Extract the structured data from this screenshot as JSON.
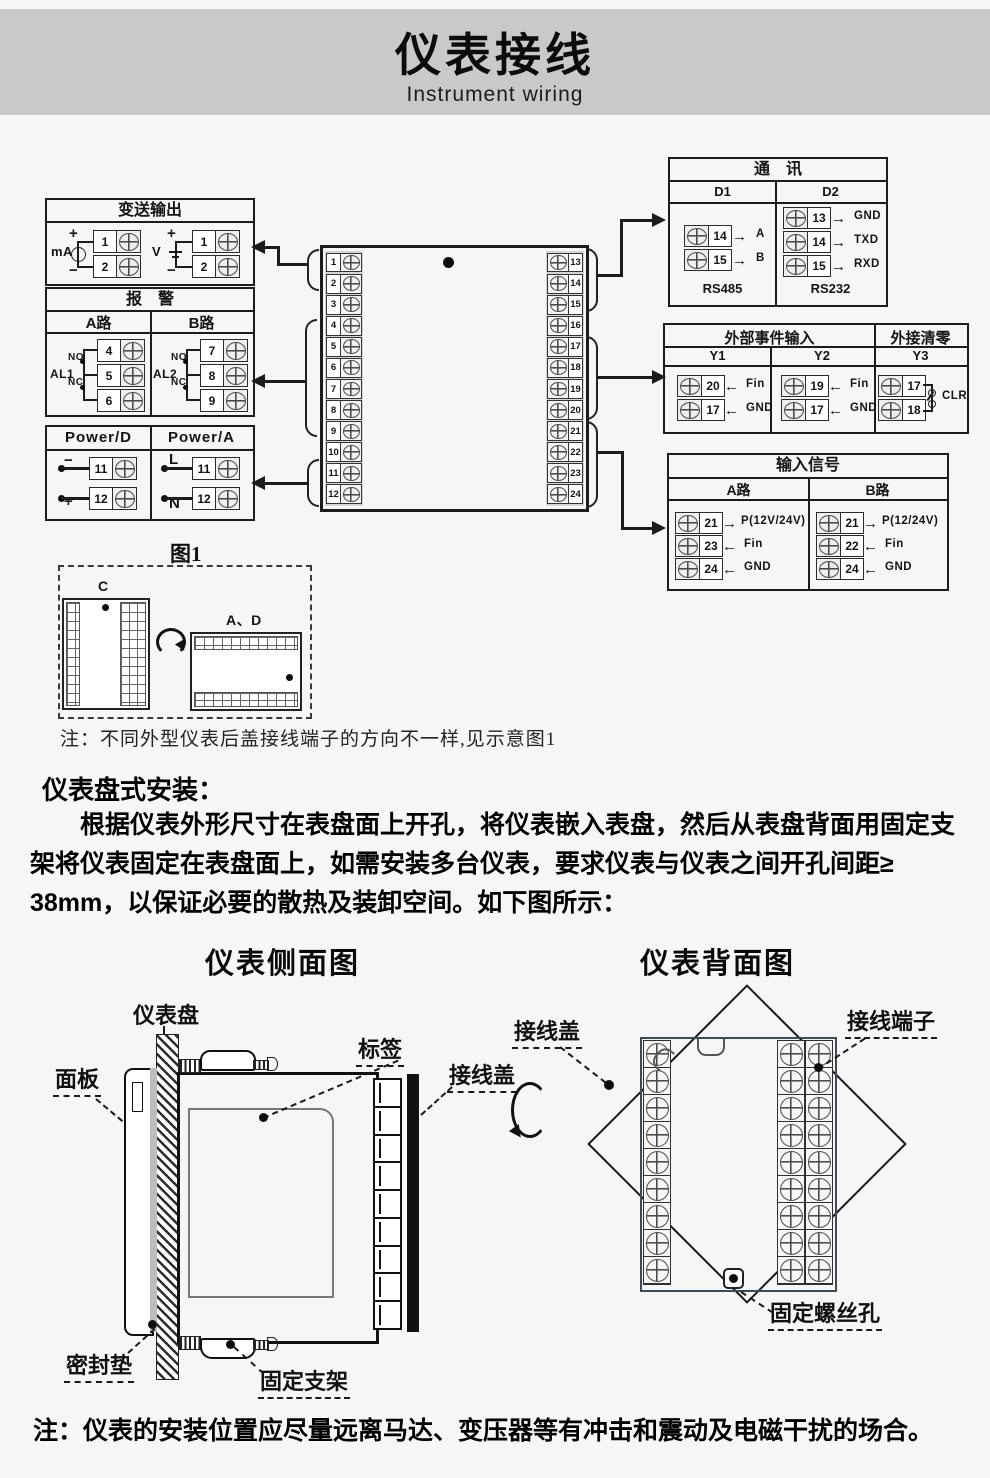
{
  "page": {
    "title": "仪表接线",
    "subtitle": "Instrument wiring"
  },
  "colors": {
    "banner": "#c9c9c9",
    "line": "#1c1c1c",
    "background": "#f6f6f5",
    "back_rect": "#3c4b57"
  },
  "wiring": {
    "transmitter": {
      "title": "变送输出",
      "groups": [
        {
          "label": "mA",
          "plus": "+",
          "minus": "−",
          "t1": "1",
          "t2": "2"
        },
        {
          "label": "V",
          "plus": "+",
          "minus": "−",
          "t1": "1",
          "t2": "2"
        }
      ]
    },
    "alarm": {
      "title": "报　警",
      "channels": [
        {
          "name": "A路",
          "relay": "AL1",
          "no": "NO",
          "nc": "NC",
          "t1": "4",
          "t2": "5",
          "t3": "6"
        },
        {
          "name": "B路",
          "relay": "AL2",
          "no": "NO",
          "nc": "NC",
          "t1": "7",
          "t2": "8",
          "t3": "9"
        }
      ]
    },
    "power": {
      "cols": [
        {
          "name": "Power/D",
          "m1": "−",
          "t1": "11",
          "m2": "+",
          "t2": "12"
        },
        {
          "name": "Power/A",
          "m1": "L",
          "t1": "11",
          "m2": "N",
          "t2": "12"
        }
      ]
    },
    "center": {
      "left": [
        "1",
        "2",
        "3",
        "4",
        "5",
        "6",
        "7",
        "8",
        "9",
        "10",
        "11",
        "12"
      ],
      "right": [
        "13",
        "14",
        "15",
        "16",
        "17",
        "18",
        "19",
        "20",
        "21",
        "22",
        "23",
        "24"
      ]
    },
    "comm": {
      "title": "通　讯",
      "cols": [
        {
          "name": "D1",
          "footer": "RS485",
          "rows": [
            {
              "num": "14",
              "dir": "→",
              "label": "A"
            },
            {
              "num": "15",
              "dir": "→",
              "label": "B"
            }
          ]
        },
        {
          "name": "D2",
          "footer": "RS232",
          "rows": [
            {
              "num": "13",
              "dir": "→",
              "label": "GND"
            },
            {
              "num": "14",
              "dir": "→",
              "label": "TXD"
            },
            {
              "num": "15",
              "dir": "→",
              "label": "RXD"
            }
          ]
        }
      ]
    },
    "event": {
      "title": "外部事件输入",
      "title2": "外接清零",
      "y1": {
        "name": "Y1",
        "rows": [
          {
            "num": "20",
            "dir": "←",
            "label": "Fin"
          },
          {
            "num": "17",
            "dir": "←",
            "label": "GND"
          }
        ]
      },
      "y2": {
        "name": "Y2",
        "rows": [
          {
            "num": "19",
            "dir": "←",
            "label": "Fin"
          },
          {
            "num": "17",
            "dir": "←",
            "label": "GND"
          }
        ]
      },
      "y3": {
        "name": "Y3",
        "t1": "17",
        "t2": "18",
        "sw": "CLR"
      }
    },
    "input": {
      "title": "输入信号",
      "cols": [
        {
          "name": "A路",
          "rows": [
            {
              "num": "21",
              "dir": "→",
              "label": "P(12V/24V)"
            },
            {
              "num": "23",
              "dir": "←",
              "label": "Fin"
            },
            {
              "num": "24",
              "dir": "←",
              "label": "GND"
            }
          ]
        },
        {
          "name": "B路",
          "rows": [
            {
              "num": "21",
              "dir": "→",
              "label": "P(12/24V)"
            },
            {
              "num": "22",
              "dir": "←",
              "label": "Fin"
            },
            {
              "num": "24",
              "dir": "←",
              "label": "GND"
            }
          ]
        }
      ]
    },
    "figure1": {
      "title": "图1",
      "label_c": "C",
      "label_ad": "A、D"
    },
    "note1": "注：不同外型仪表后盖接线端子的方向不一样,见示意图1"
  },
  "install": {
    "heading": "仪表盘式安装：",
    "paragraph": "　　根据仪表外形尺寸在表盘面上开孔，将仪表嵌入表盘，然后从表盘背面用固定支\n架将仪表固定在表盘面上，如需安装多台仪表，要求仪表与仪表之间开孔间距≥\n38mm，以保证必要的散热及装卸空间。如下图所示：",
    "side_view": {
      "title": "仪表侧面图",
      "panel_board": "仪表盘",
      "front_panel": "面板",
      "tag": "标签",
      "cover": "接线盖",
      "gasket": "密封垫",
      "bracket": "固定支架"
    },
    "back_view": {
      "title": "仪表背面图",
      "cover": "接线盖",
      "terminals": "接线端子",
      "screw_hole": "固定螺丝孔"
    },
    "note": "注：仪表的安装位置应尽量远离马达、变压器等有冲击和震动及电磁干扰的场合。"
  }
}
